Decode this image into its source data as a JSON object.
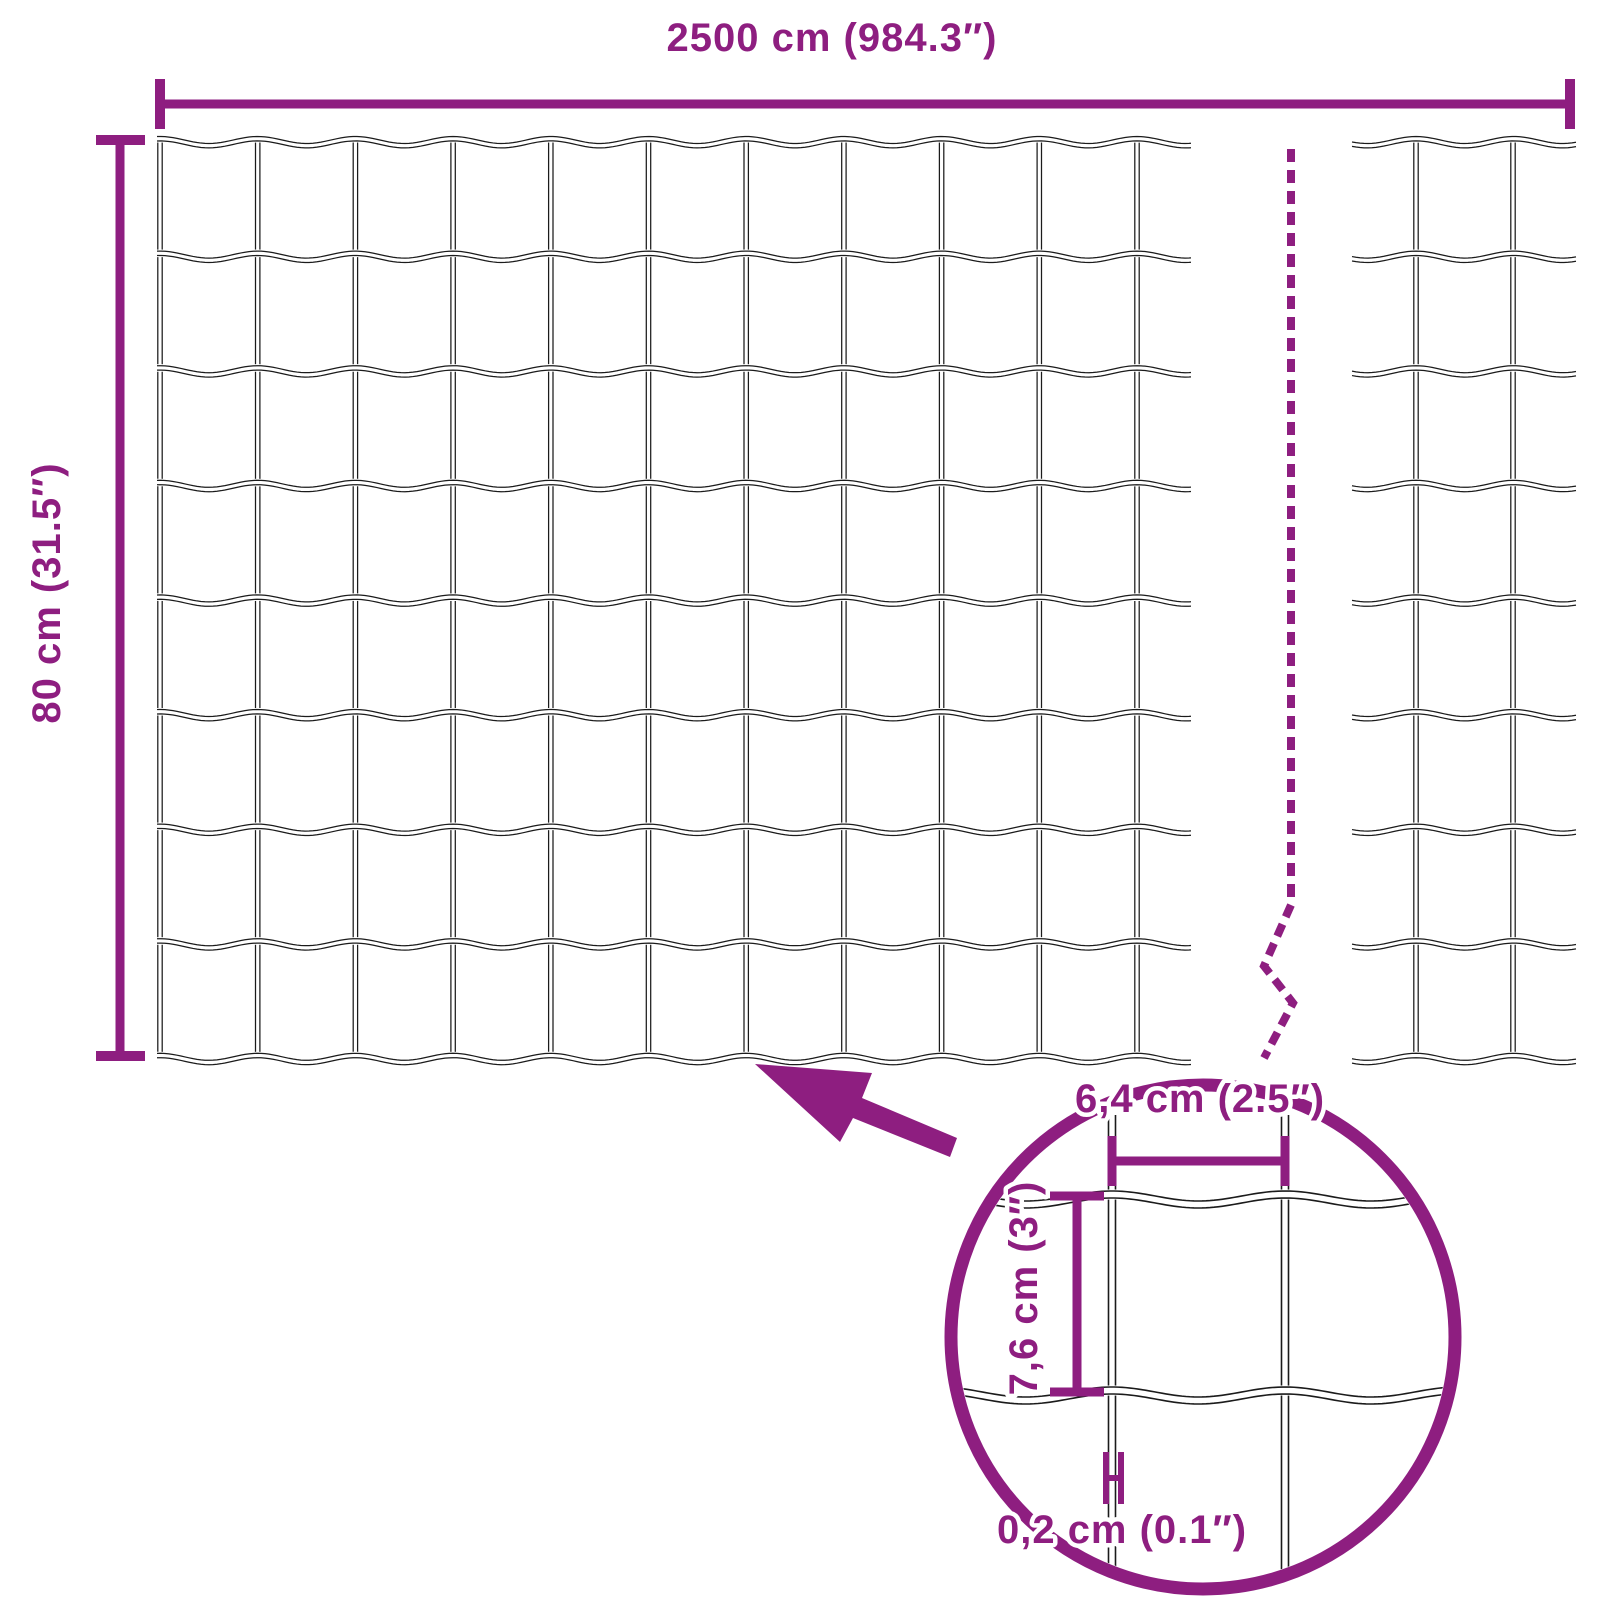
{
  "diagram": {
    "kind": "product-dimension-diagram",
    "subject": "welded wire mesh fence roll"
  },
  "colors": {
    "accent": "#8E1E80",
    "wire": "#1b1b1b",
    "background": "#ffffff"
  },
  "labels": {
    "roll_length": "2500 cm (984.3″)",
    "roll_height": "80 cm (31.5″)",
    "mesh_width": "6,4 cm (2.5″)",
    "mesh_height": "7,6 cm (3″)",
    "wire_thickness": "0,2 cm (0.1″)"
  },
  "geometry": {
    "canvas": {
      "width": 1600,
      "height": 1600
    },
    "wire_style": {
      "stroke": 1.25,
      "pair_gap": 4.4,
      "band": 7.5
    },
    "detail_wire_style": {
      "stroke": 1.6,
      "pair_gap": 7,
      "band": 10
    },
    "main_mesh": {
      "posts_x_start": 160,
      "post_spacing": 97.7,
      "post_count": 11,
      "rows_y_start": 140,
      "row_spacing": 114.6,
      "row_count": 9,
      "post_y1": 141,
      "post_y2": 1056,
      "wavy_x1": 157,
      "wavy_x2": 1191,
      "wave_amp": 3.5
    },
    "end_piece": {
      "posts": [
        1416,
        1513
      ],
      "phase_x": 1416,
      "wavy_x1": 1352,
      "wavy_x2": 1576
    },
    "break_line": {
      "points": "1291,149 1291,905 1264,966 1293,1003 1264,1058",
      "width": 8,
      "dash": "13 8"
    },
    "dim_length": {
      "line": [
        160,
        104,
        1570,
        104
      ],
      "line_w": 9,
      "tick_w": 10,
      "ticks": [
        [
          160,
          79,
          160,
          129
        ],
        [
          1570,
          79,
          1570,
          129
        ]
      ],
      "label_x": 832,
      "label_y": 51
    },
    "dim_height": {
      "line": [
        120,
        140,
        120,
        1056
      ],
      "line_w": 9,
      "tick_w": 10,
      "ticks": [
        [
          96,
          140,
          145,
          140
        ],
        [
          96,
          1056,
          145,
          1056
        ]
      ],
      "label_x": 60,
      "label_y": 593
    },
    "arrow_points": "755,1064 872,1073 862,1098 957,1138 950,1157 853,1118 840,1142",
    "detail": {
      "cx": 1203,
      "cy": 1337,
      "r": 252,
      "ring_w": 13,
      "clip_r": 245,
      "posts": [
        1112,
        1285
      ],
      "post_top": 1115,
      "post_bottom": 1585,
      "rows": [
        1196,
        1392
      ],
      "wavy_x1": 950,
      "wavy_x2": 1456,
      "wave_amp": 5,
      "post_spacing": 173,
      "dim_w": {
        "line": [
          1112,
          1161,
          1285,
          1161
        ],
        "line_w": 9,
        "ticks": [
          [
            1112,
            1136,
            1112,
            1186
          ],
          [
            1285,
            1136,
            1285,
            1186
          ]
        ],
        "label_x": 1200,
        "label_y": 1112
      },
      "dim_h": {
        "line": [
          1077,
          1196,
          1077,
          1392
        ],
        "line_w": 9,
        "ticks": [
          [
            1050,
            1196,
            1104,
            1196
          ],
          [
            1050,
            1392,
            1104,
            1392
          ]
        ],
        "label_x": 1037,
        "label_y": 1288
      },
      "gauge": {
        "bars": [
          [
            1106,
            1452,
            1106,
            1504
          ],
          [
            1121,
            1452,
            1121,
            1504
          ],
          [
            1103,
            1478,
            1124,
            1478
          ]
        ],
        "width": 6,
        "label_x": 1122,
        "label_y": 1543
      }
    }
  }
}
